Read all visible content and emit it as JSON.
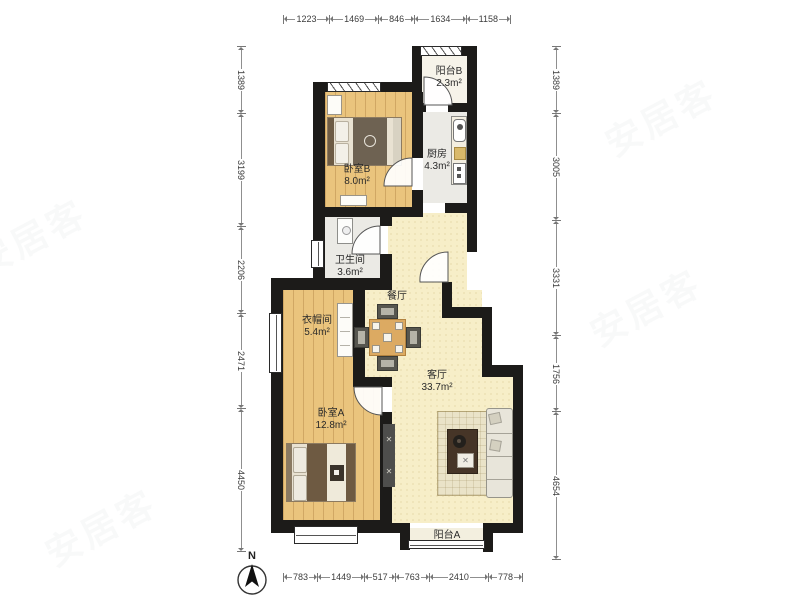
{
  "watermark": "安居客",
  "compass": {
    "label": "N"
  },
  "rooms": {
    "balcony_b": {
      "name": "阳台B",
      "area": "2.3m²"
    },
    "kitchen": {
      "name": "厨房",
      "area": "4.3m²"
    },
    "bedroom_b": {
      "name": "卧室B",
      "area": "8.0m²"
    },
    "bathroom": {
      "name": "卫生间",
      "area": "3.6m²"
    },
    "dining": {
      "name": "餐厅"
    },
    "closet": {
      "name": "衣帽间",
      "area": "5.4m²"
    },
    "living": {
      "name": "客厅",
      "area": "33.7m²"
    },
    "bedroom_a": {
      "name": "卧室A",
      "area": "12.8m²"
    },
    "balcony_a": {
      "name": "阳台A"
    }
  },
  "dimensions": {
    "top": [
      1223,
      1469,
      846,
      1634,
      1158
    ],
    "bottom": [
      783,
      1449,
      517,
      763,
      2410,
      778
    ],
    "left": [
      1389,
      3199,
      2206,
      2471,
      4450
    ],
    "right": [
      1389,
      3005,
      3331,
      1756,
      4654
    ]
  },
  "colors": {
    "wall": "#1c1b19",
    "wood_floor": "#eac47d",
    "living_floor": "#f7eec8",
    "service_floor": "#ebeae5"
  }
}
